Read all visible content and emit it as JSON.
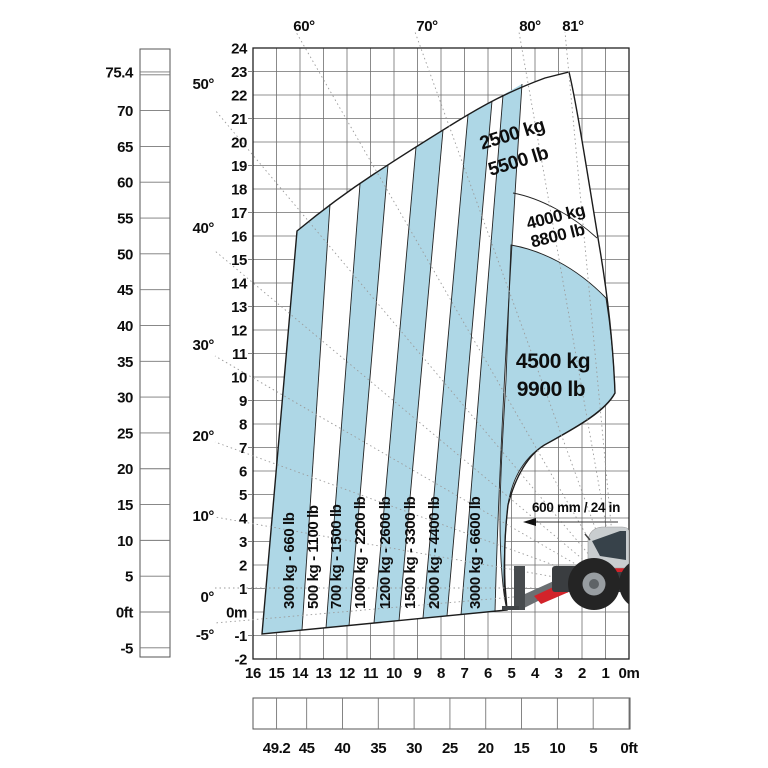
{
  "colors": {
    "zone_blue": "#aed7e6",
    "grid_line": "#6e6e6e",
    "outline": "#1c1c1c",
    "machine_red": "#d2232a",
    "machine_gray": "#c9cdcf",
    "machine_dark": "#3a3d40"
  },
  "top_angle_labels": [
    "60°",
    "70°",
    "80°",
    "81°"
  ],
  "left_angle_labels": [
    "50°",
    "40°",
    "30°",
    "20°",
    "10°",
    "0°",
    "-5°"
  ],
  "left_feet_axis": {
    "labels": [
      "75.4",
      "70",
      "65",
      "60",
      "55",
      "50",
      "45",
      "40",
      "35",
      "30",
      "25",
      "20",
      "15",
      "10",
      "5",
      "0ft",
      "-5"
    ]
  },
  "left_meter_axis": {
    "labels": [
      "24",
      "23",
      "22",
      "21",
      "20",
      "19",
      "18",
      "17",
      "16",
      "15",
      "14",
      "13",
      "12",
      "11",
      "10",
      "9",
      "8",
      "7",
      "6",
      "5",
      "4",
      "3",
      "2",
      "1",
      "0m",
      "-1",
      "-2"
    ]
  },
  "bottom_meter_axis": {
    "labels": [
      "16",
      "15",
      "14",
      "13",
      "12",
      "11",
      "10",
      "9",
      "8",
      "7",
      "6",
      "5",
      "4",
      "3",
      "2",
      "1",
      "0m"
    ]
  },
  "bottom_feet_axis": {
    "labels": [
      "49.2",
      "45",
      "40",
      "35",
      "30",
      "25",
      "20",
      "15",
      "10",
      "5",
      "0ft"
    ]
  },
  "capacity_stripes": [
    "300 kg - 660 lb",
    "500 kg - 1100 lb",
    "700 kg - 1500 lb",
    "1000 kg - 2200 lb",
    "1200 kg - 2600 lb",
    "1500 kg - 3300 lb",
    "2000 kg - 4400 lb",
    "3000 kg - 6600 lb"
  ],
  "capacity_zones": [
    {
      "kg": "2500 kg",
      "lb": "5500 lb"
    },
    {
      "kg": "4000 kg",
      "lb": "8800 lb"
    },
    {
      "kg": "4500 kg",
      "lb": "9900 lb"
    }
  ],
  "annotation": "600 mm / 24 in",
  "machine_brand": "MANITOU"
}
